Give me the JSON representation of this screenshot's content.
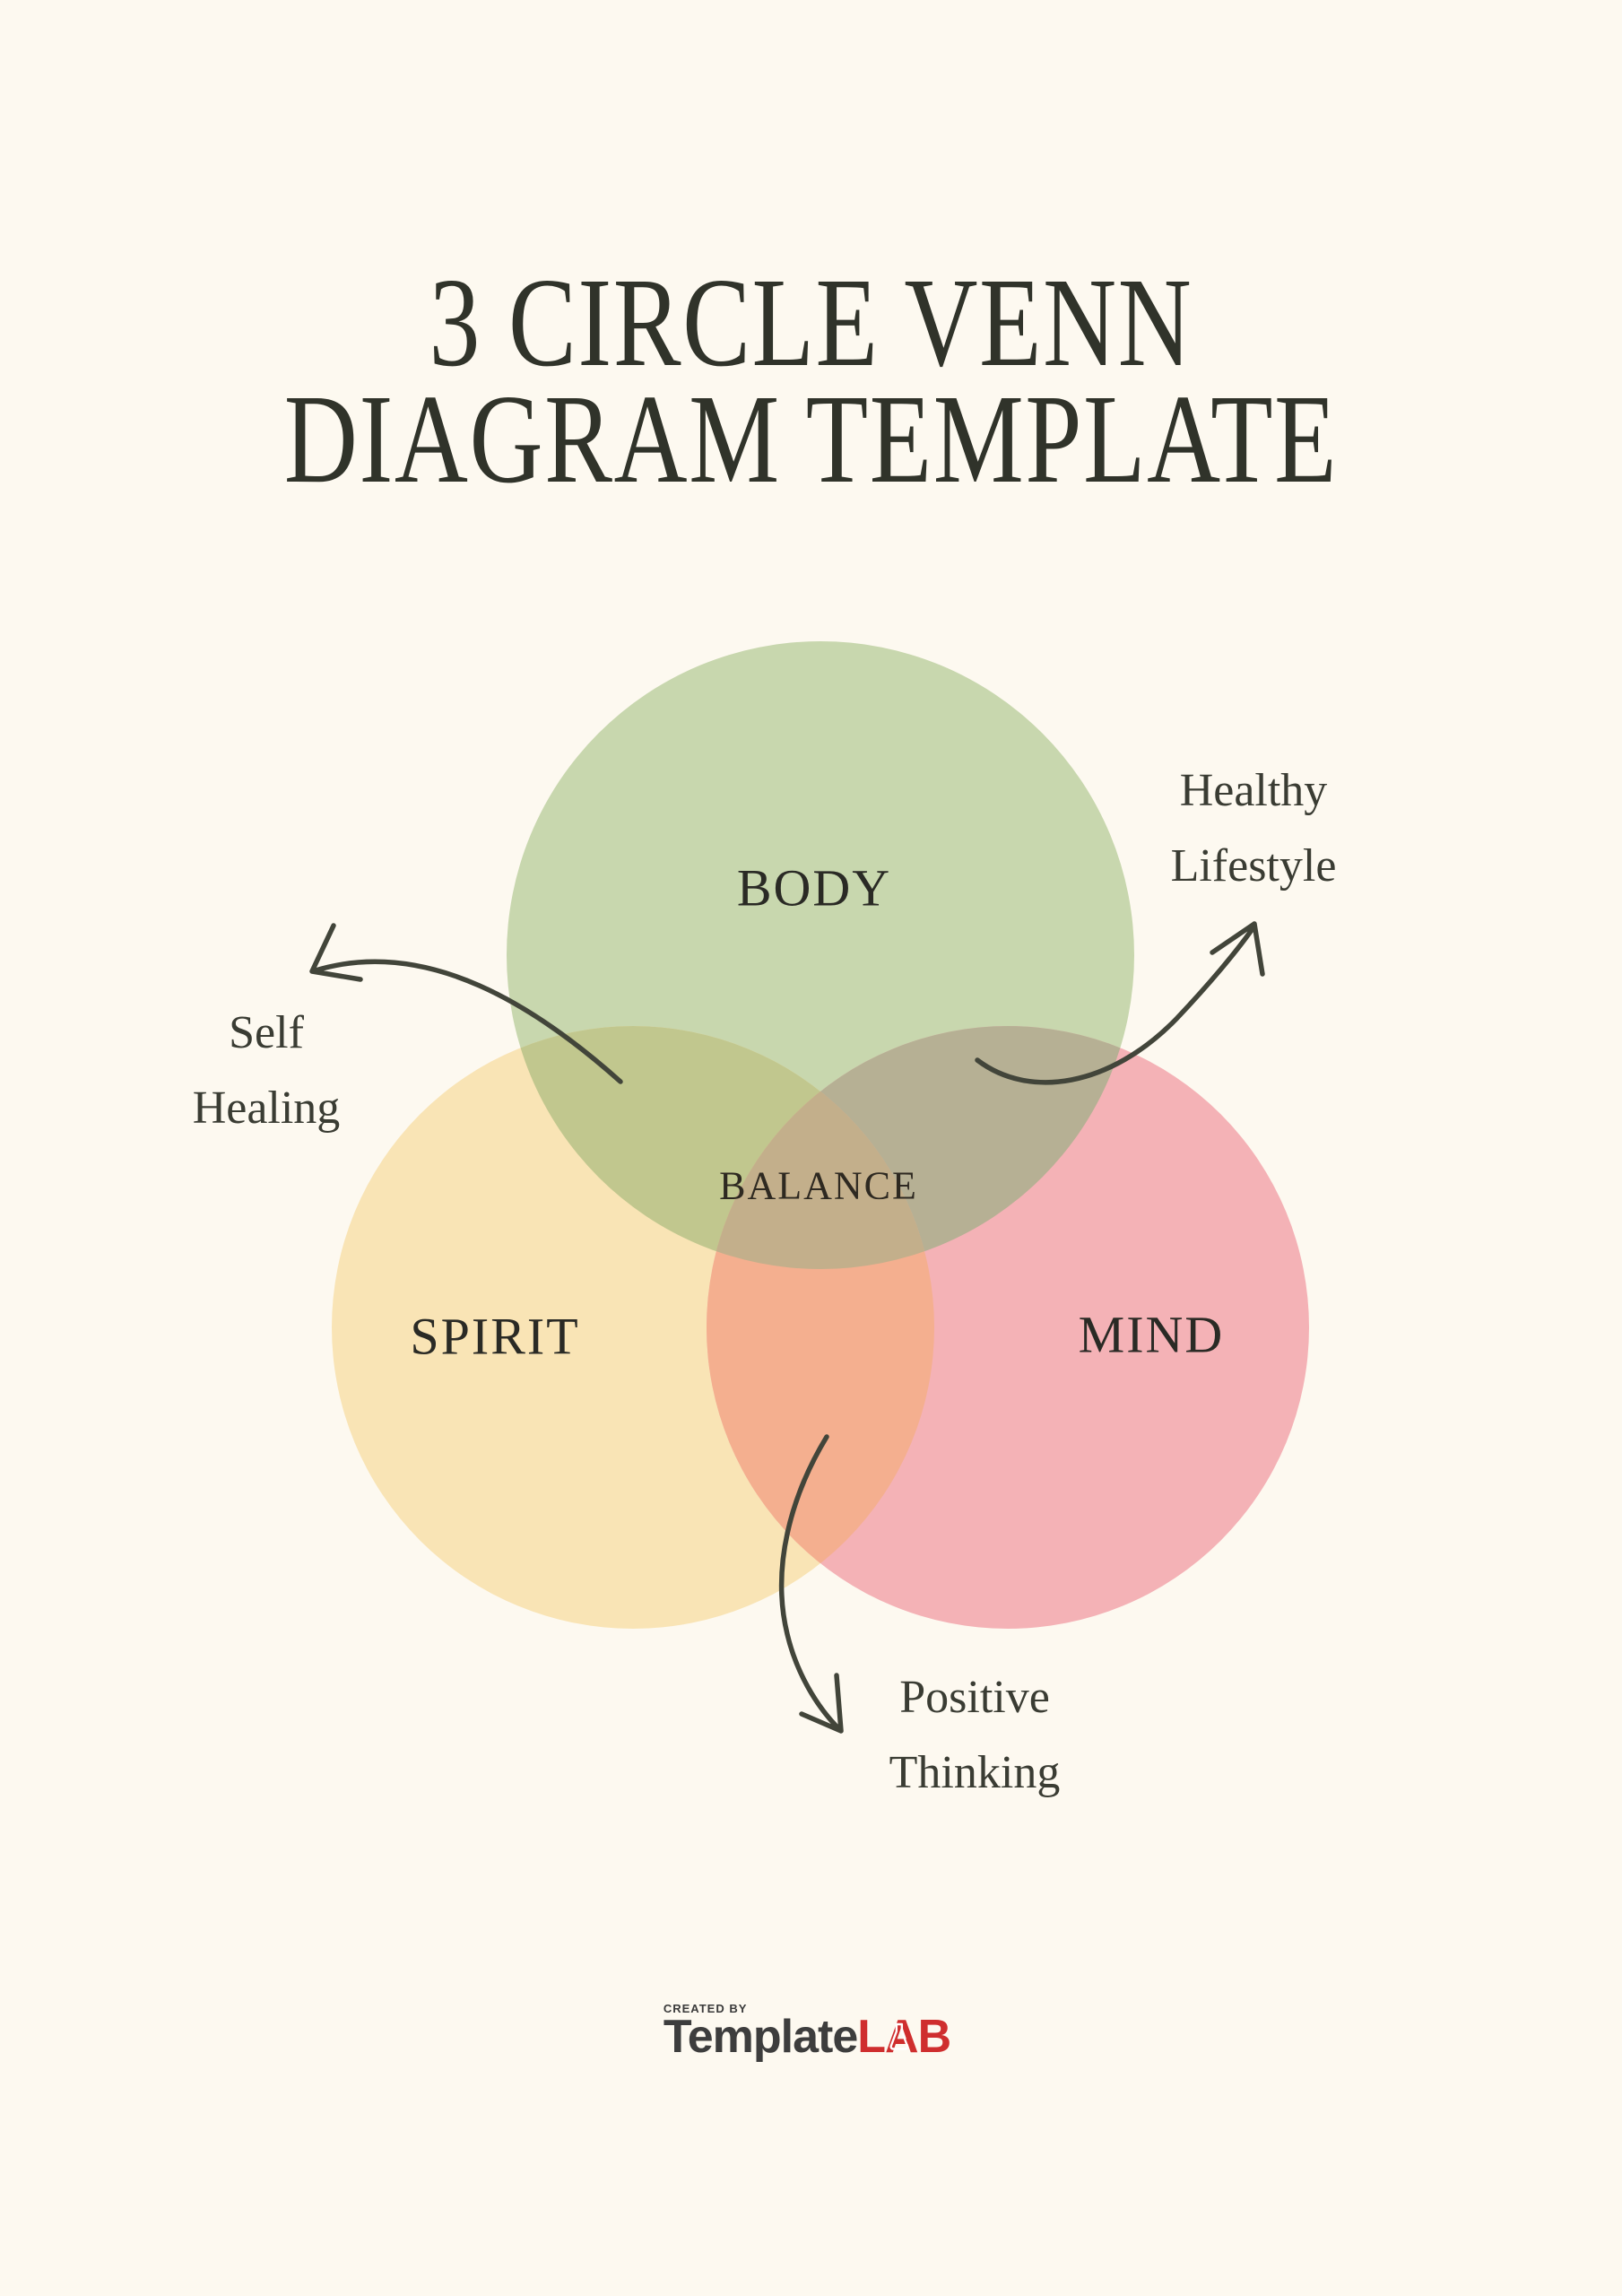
{
  "title": {
    "line1": "3 CIRCLE VENN",
    "line2": "DIAGRAM TEMPLATE"
  },
  "venn": {
    "body_label": "BODY",
    "spirit_label": "SPIRIT",
    "mind_label": "MIND",
    "balance_label": "BALANCE",
    "colors": {
      "body": "#c8d7ae",
      "spirit": "#f9e4b5",
      "mind": "#f4b2b6",
      "body_spirit": "#c1c78e",
      "body_mind": "#b6b094",
      "spirit_mind": "#f4af8f",
      "triple": "#c3af8b"
    }
  },
  "annotations": {
    "self_healing": {
      "line1": "Self",
      "line2": "Healing"
    },
    "healthy_lifestyle": {
      "line1": "Healthy",
      "line2": "Lifestyle"
    },
    "positive_thinking": {
      "line1": "Positive",
      "line2": "Thinking"
    }
  },
  "footer": {
    "created_by": "CREATED BY",
    "brand_dark": "Template",
    "brand_red": "LAB",
    "flask_icon": "erlenmeyer-flask"
  },
  "colors": {
    "background": "#fdf9f0",
    "title_text": "#30332a",
    "label_text": "#2a2a25",
    "annotation_text": "#3a3c33",
    "arrow": "#42453a",
    "brand_dark": "#3d3d3d",
    "brand_red": "#cf2e2e"
  }
}
